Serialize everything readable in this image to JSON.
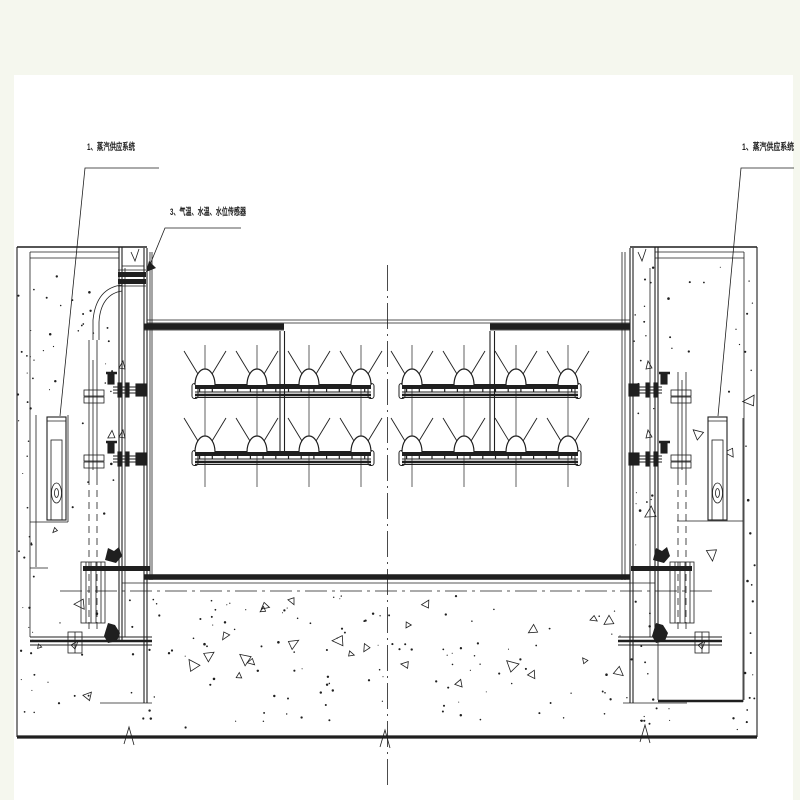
{
  "drawing": {
    "kind": "engineering-section-drawing",
    "labels": {
      "steam_supply_left": "1、蒸汽供应系统",
      "sensors": "3、气温、水温、水位传感器",
      "steam_supply_right": "1、蒸汽供应系统"
    },
    "colors": {
      "line": "#1f1f1f",
      "paper": "#ffffff",
      "margin": "#f5f7ee"
    }
  }
}
